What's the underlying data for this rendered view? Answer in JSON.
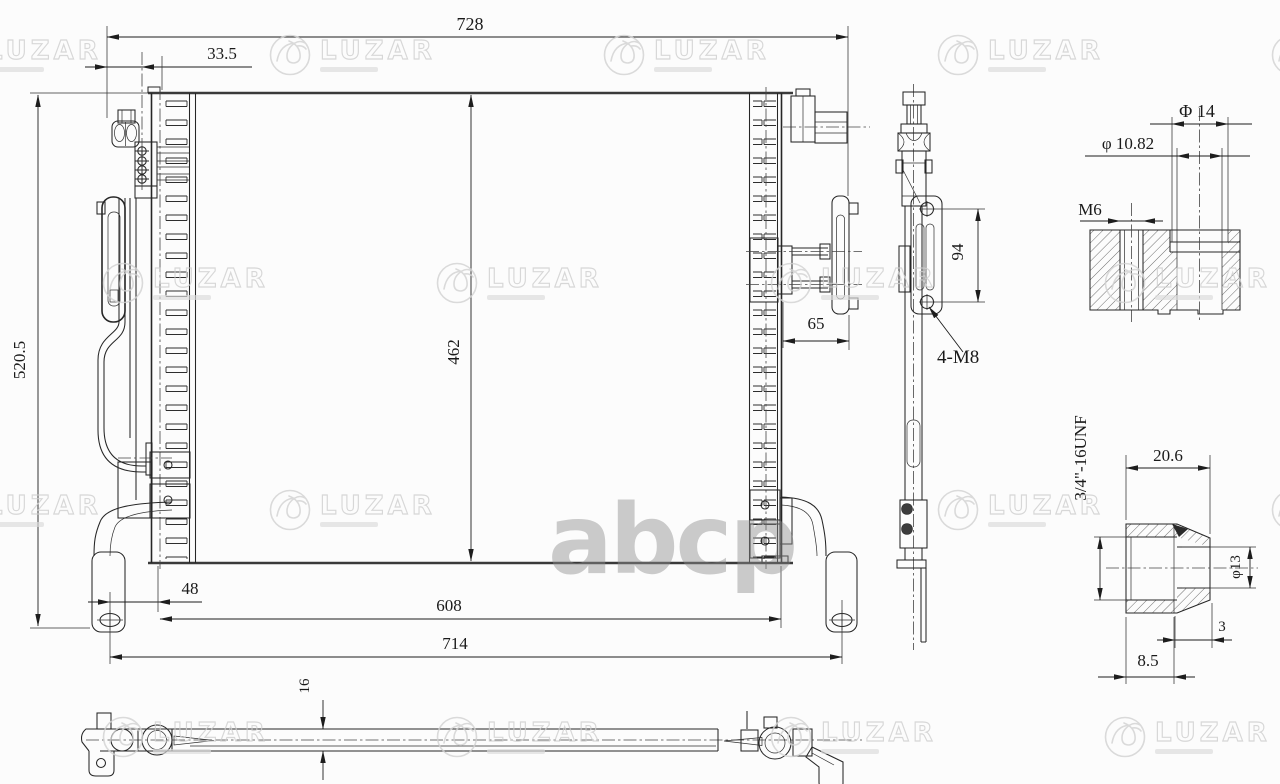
{
  "document": {
    "type": "engineering-drawing",
    "subject": "condenser"
  },
  "watermark": {
    "brand": "LUZAR",
    "store": "abcp"
  },
  "front_view": {
    "overall_width": "728",
    "pipe_offset": "33.5",
    "overall_height": "520.5",
    "core_height": "462",
    "core_width": "608",
    "mount_width": "714",
    "foot_offset": "48",
    "bracket_depth": "65"
  },
  "side_view": {
    "hole_spacing": "94",
    "mount_thread": "4-M8"
  },
  "boss_detail": {
    "outer_dia": "Φ 14",
    "bore_dia": "φ 10.82",
    "thread": "M6"
  },
  "fitting_detail": {
    "thread": "3/4\"-16UNF",
    "length": "20.6",
    "bore_dia": "φ13",
    "step": "3",
    "depth": "8.5"
  },
  "bottom_view": {
    "plate_thickness": "16"
  }
}
